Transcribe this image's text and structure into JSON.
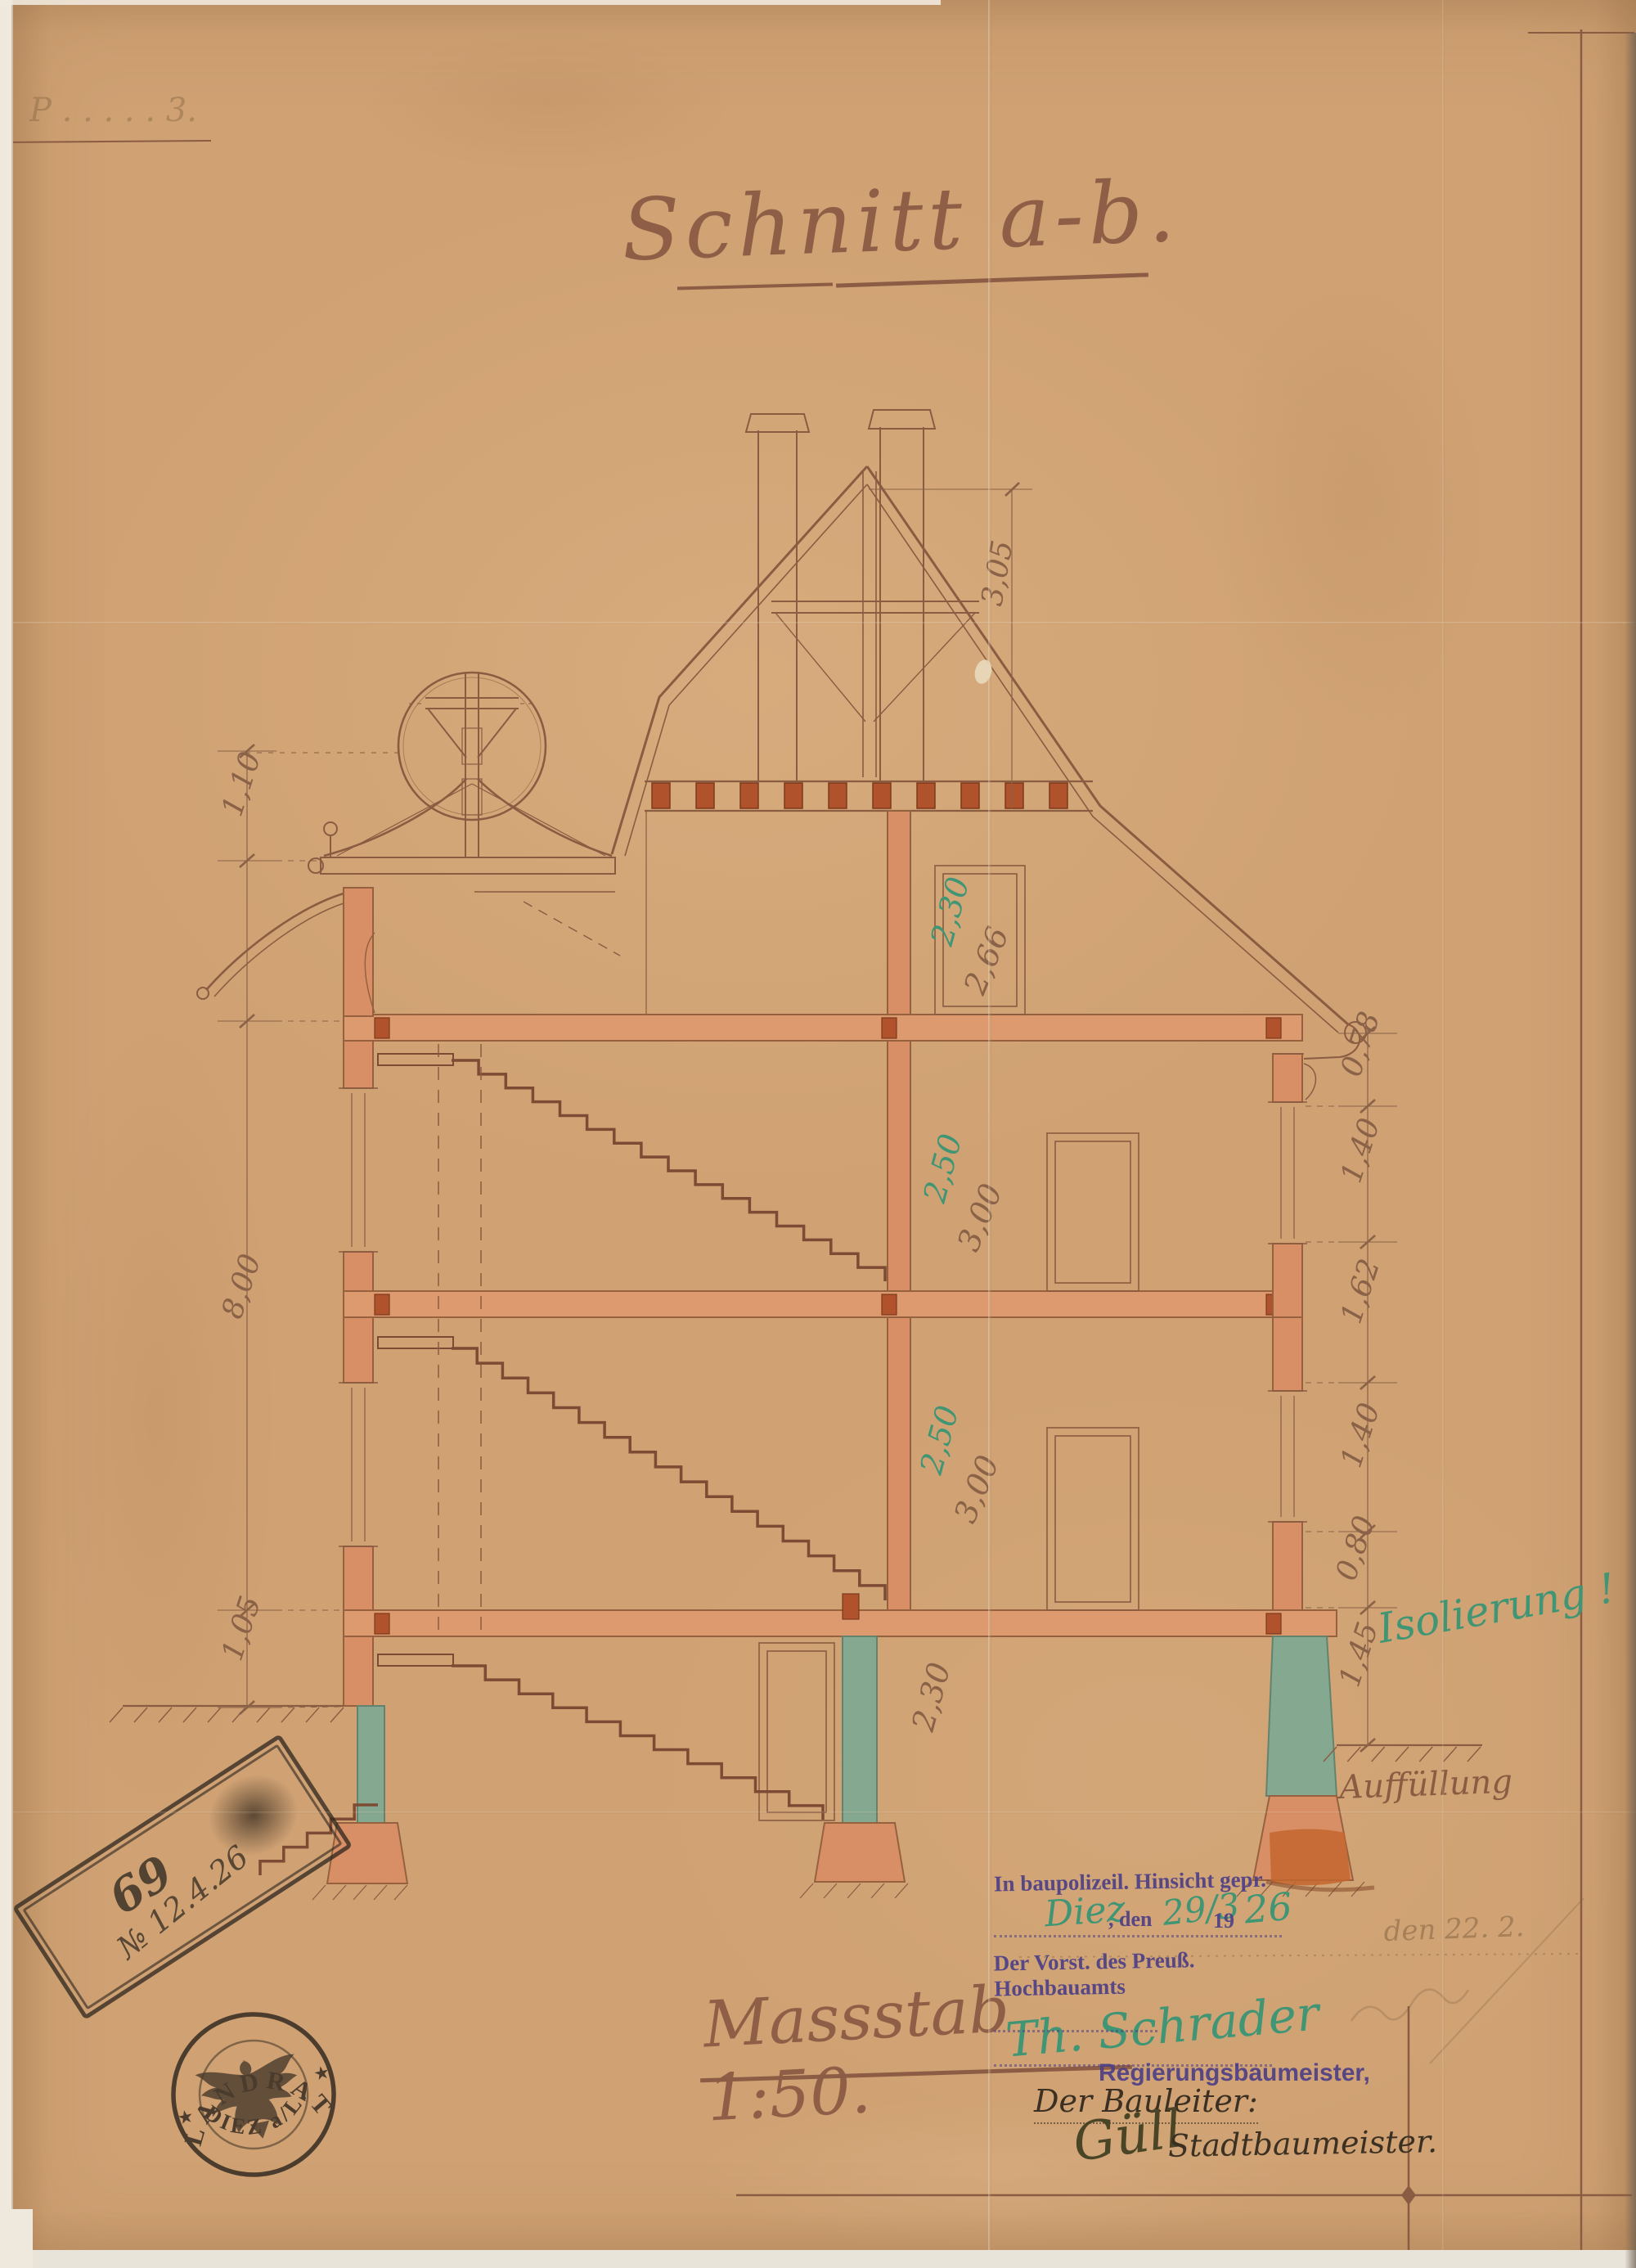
{
  "title": "Schnitt a-b.",
  "corner_note": "P . . . . .  3.",
  "scale_line": "Massstab 1:50.",
  "colors": {
    "paper": "#cfa173",
    "ink_brown": "#8a5c42",
    "wall_fill": "#d88f66",
    "joist_fill": "#b0522b",
    "teal_fill": "#84a890",
    "green_ink": "#3f9574",
    "stamp_purple": "#4c3f85",
    "stamp_black": "#332a22"
  },
  "dims": {
    "roof_height": "3,05",
    "right_chain": [
      "0,78",
      "1,40",
      "1,62",
      "1,40",
      "0,80",
      "1,45"
    ],
    "left_chain": [
      "1,10",
      "8,00",
      "1,05"
    ],
    "floors": {
      "attic_green": "2,30",
      "attic_brown": "2,66",
      "f2_green": "2,50",
      "f2_brown": "3,00",
      "f1_green": "2,50",
      "f1_brown": "3,00",
      "basement_brown": "2,30"
    }
  },
  "notes": {
    "isolierung": "Isolierung !",
    "auffuellung": "Auffüllung",
    "pencil_date": "den 22. 2."
  },
  "approval": {
    "line1": "In baupolizeil. Hinsicht gepr.",
    "place_hw": "Diez",
    "den": ", den",
    "day_hw": "29/3",
    "year_print": "19",
    "year_hw": "26",
    "vorstand": "Der Vorst. des Preuß. Hochbauamts",
    "signature": "Th. Schrader",
    "beruf": "Regierungsbaumeister,"
  },
  "bauleiter": {
    "label": "Der Bauleiter:",
    "signature": "Güll",
    "beruf": "Stadtbaumeister."
  },
  "registry_stamp": {
    "number": "69",
    "date": "№ 12.4.26"
  },
  "seal": {
    "top": "LANDRAT",
    "bottom": "DIEZ a/L.",
    "star_left": "★",
    "star_right": "★"
  }
}
